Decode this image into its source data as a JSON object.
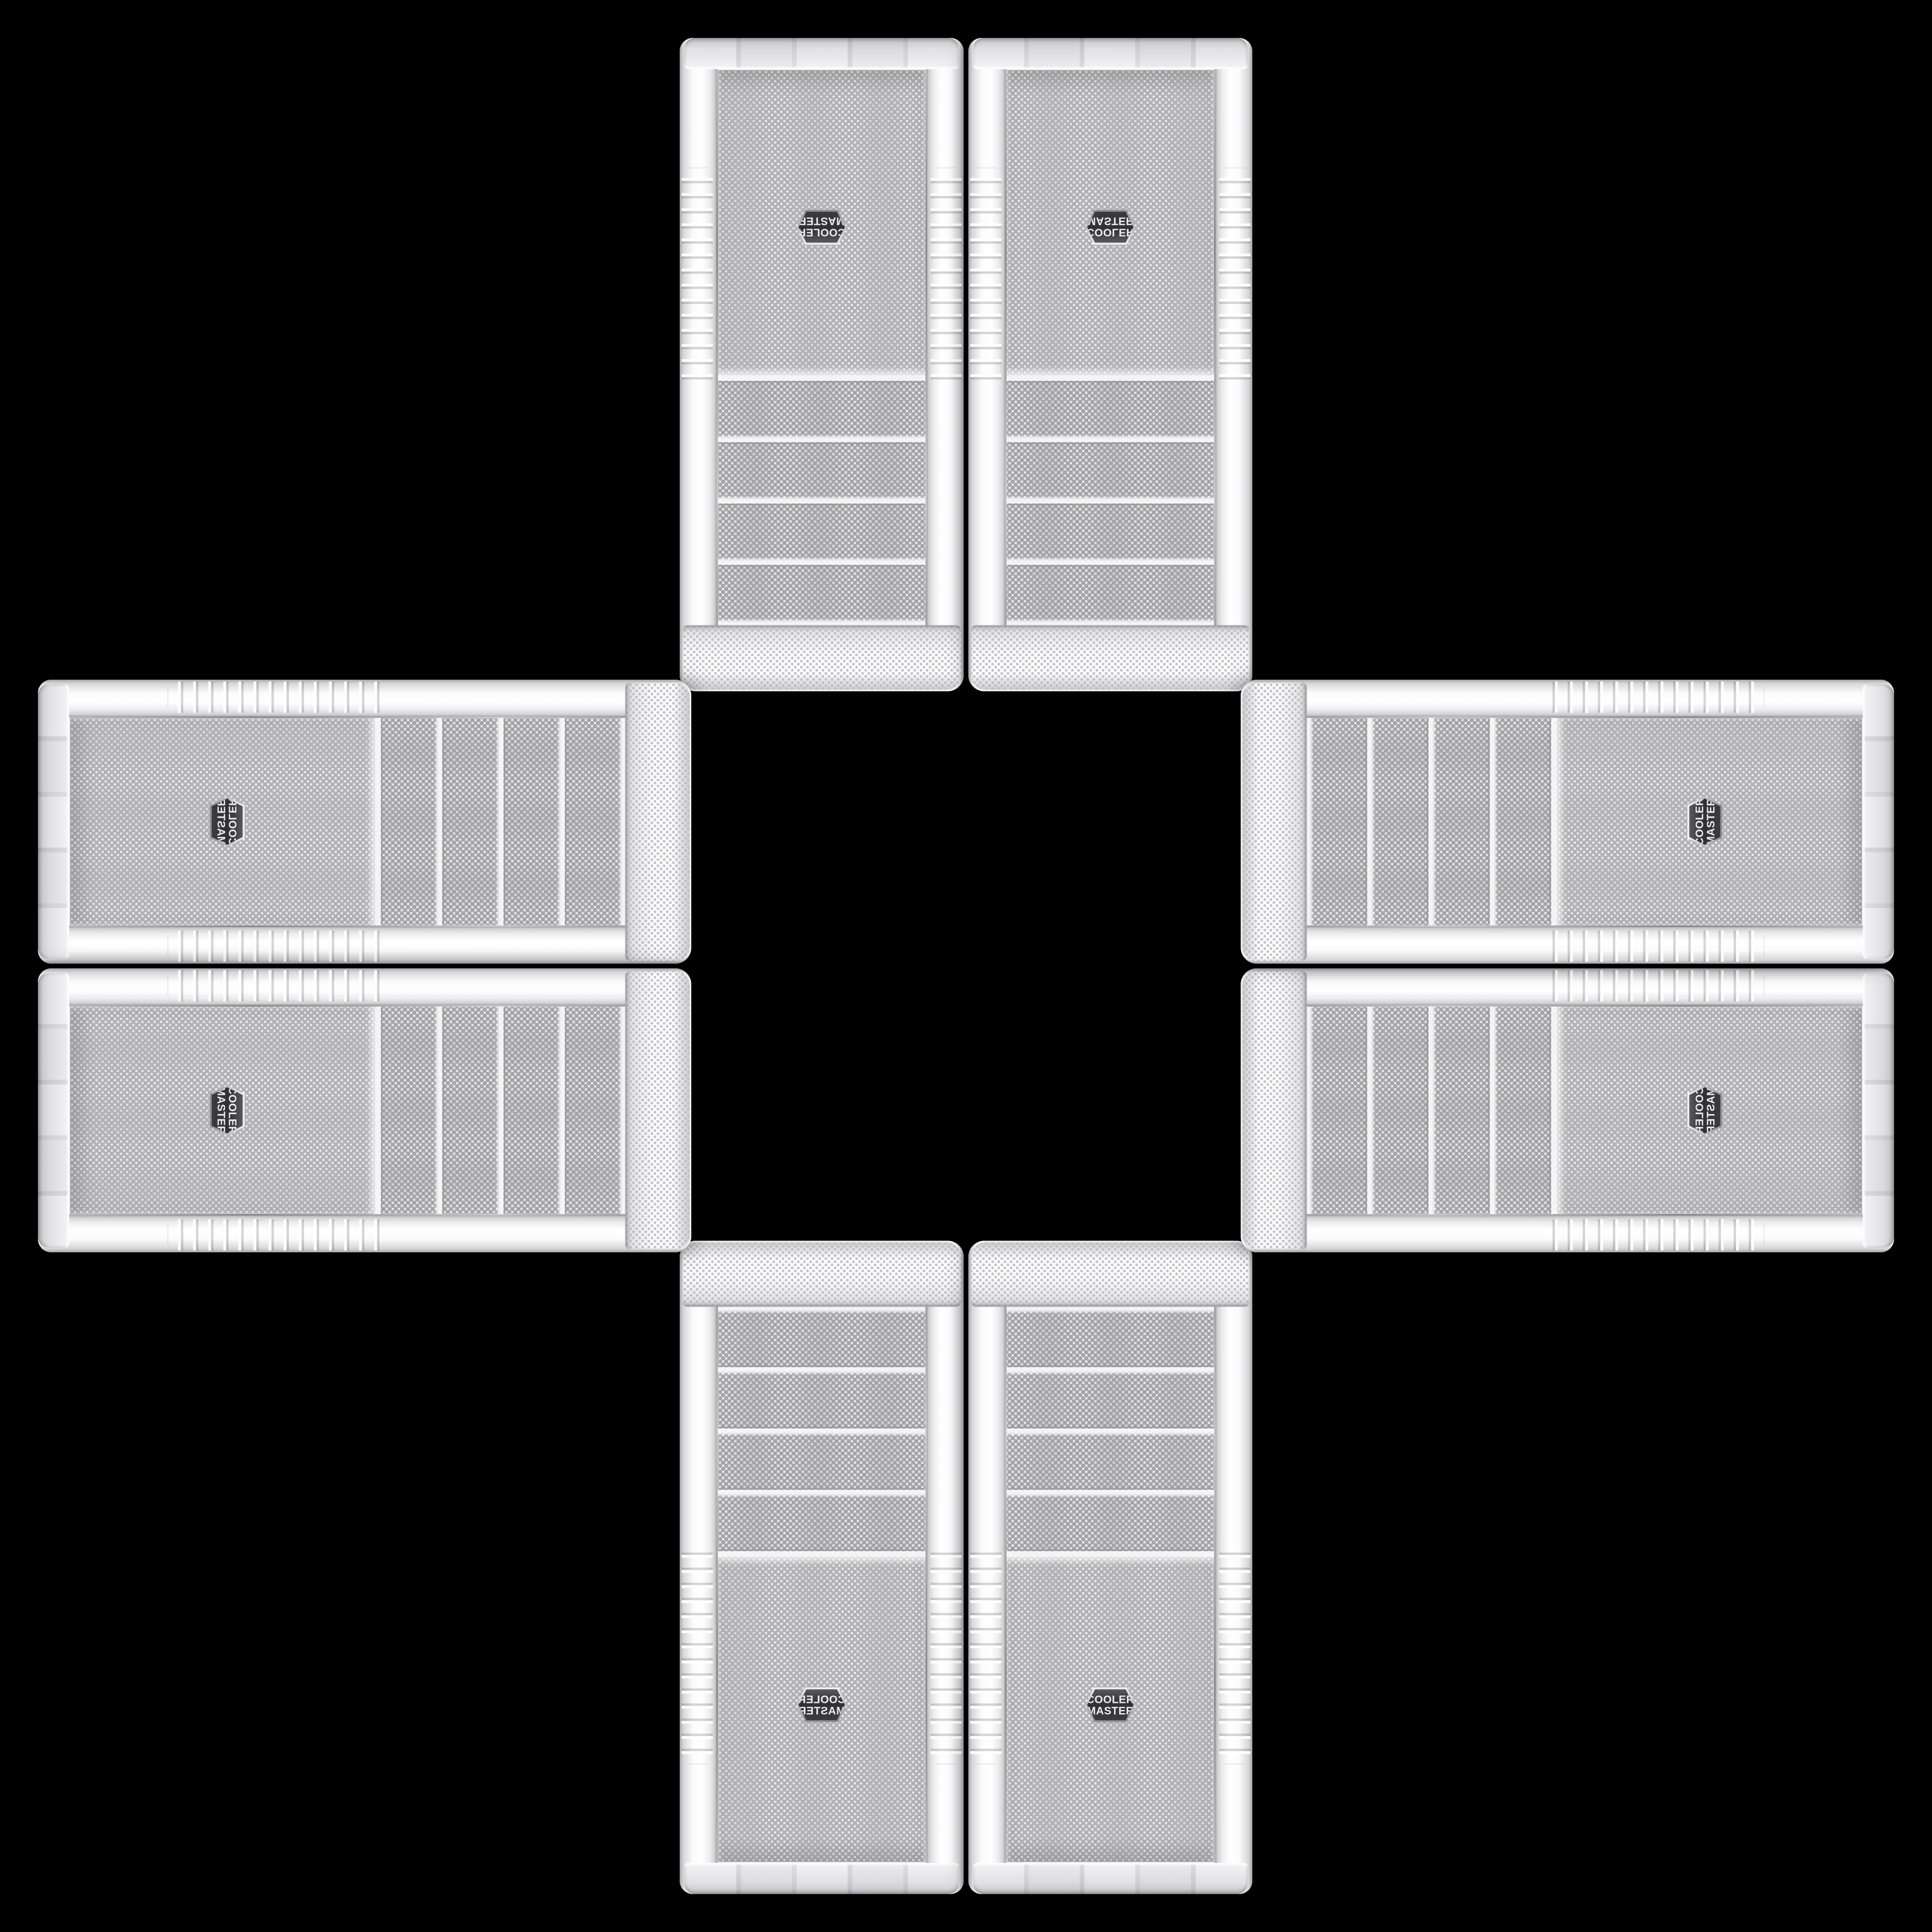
{
  "background_color": "#000000",
  "badge": {
    "line1": "COOLER",
    "line2": "MASTER"
  },
  "composition": {
    "case_count": 8,
    "pairs": [
      "top",
      "bottom",
      "left",
      "right"
    ],
    "cases_per_pair": 2,
    "drive_bays_per_case": 4
  },
  "colors": {
    "background": "#000000",
    "case_body": "#f3f3f4",
    "case_edge_shadow": "#aaaaad",
    "mesh_base": "#ededef",
    "mesh_dot": "#b2b2b6",
    "bay_mesh_dot": "#a4a4a8",
    "badge_face": "#303034",
    "badge_rim": "#c2c2c6",
    "badge_text": "#eaeaeb"
  }
}
